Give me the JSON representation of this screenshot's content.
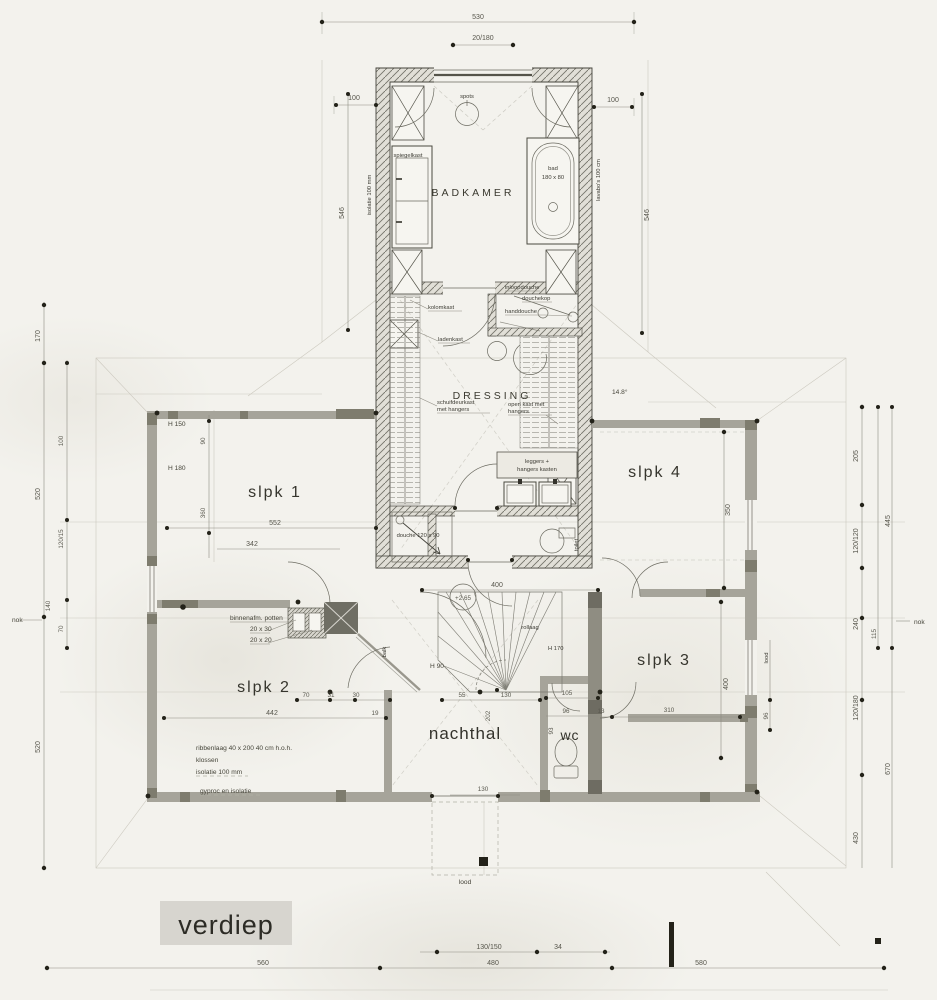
{
  "title": {
    "label": "verdiep"
  },
  "rooms": {
    "badkamer": "BADKAMER",
    "dressing": "DRESSING",
    "slpk1": "slpk 1",
    "slpk2": "slpk 2",
    "slpk3": "slpk 3",
    "slpk4": "slpk 4",
    "nachthal": "nachthal",
    "wc": "wc"
  },
  "fixtures": {
    "spots": "spots",
    "spiegelkast": "spiegelkast",
    "bad_1": "bad",
    "bad_2": "180 x 80",
    "inloopdouche": "inloopdouche",
    "douchekop": "douchekop",
    "handdouche": "handdouche",
    "kolomkast": "kolomkast",
    "ladenkast": "ladenkast",
    "schuifdeurkast_1": "schuifdeurkast",
    "schuifdeurkast_2": "met hangers",
    "openkast_1": "open kast met",
    "openkast_2": "hangers",
    "leggers_1": "leggers +",
    "leggers_2": "hangers kasten",
    "douche": "douche 120 x 90",
    "toilet": "toilet",
    "isolatie_note": "isolatie 100 mm",
    "lavabo_note": "lavabo's 100 cm"
  },
  "annotations": {
    "binnenafm": "binnenafm. potten",
    "pot_1": "20 x 30",
    "pot_2": "20 x 20",
    "ribbenlaag": "ribbenlaag  40 x 200      40 cm  h.o.h.",
    "klossen": "klossen",
    "isolatie": "isolatie          100 mm",
    "gyproc": "gyproc en isolatie",
    "balk": "balk",
    "rollaag": "rollaag",
    "h90": "H 90",
    "h170": "H 170",
    "h150": "H 150",
    "h180": "H 180",
    "nok": "nok",
    "lood": "lood",
    "level": "+2.65",
    "angle": "14.8°"
  },
  "dims": {
    "total_top": "530",
    "window_top": "20/180",
    "left_100": "100",
    "right_100": "100",
    "left_546": "546",
    "right_546": "546",
    "slpk1_w": "552",
    "slpk1_w2": "342",
    "v90": "90",
    "v360": "360",
    "stair_400": "400",
    "slpk4_h": "350",
    "slpk3_h": "400",
    "slpk2_w": "442",
    "d19": "19",
    "d70": "70",
    "d31": "31",
    "d30": "30",
    "d55": "55",
    "d130": "130",
    "d202": "202",
    "d105": "105",
    "d96": "96",
    "d93": "93",
    "d310": "310",
    "d13": "13",
    "hall_130": "130",
    "bot_130_150": "130/150",
    "bot_34": "34",
    "bot_480": "480",
    "bot_580": "580",
    "bot_560": "560",
    "l_170": "170",
    "l_520a": "520",
    "l_520b": "520",
    "l_140": "140",
    "l_100": "100",
    "l_120_15": "120/15",
    "l_70": "70",
    "r_205": "205",
    "r_120_120": "120/120",
    "r_240": "240",
    "r_115": "115",
    "r_445": "445",
    "r_120_180": "120/180",
    "r_670": "670",
    "r_430": "430",
    "r_96": "96"
  }
}
